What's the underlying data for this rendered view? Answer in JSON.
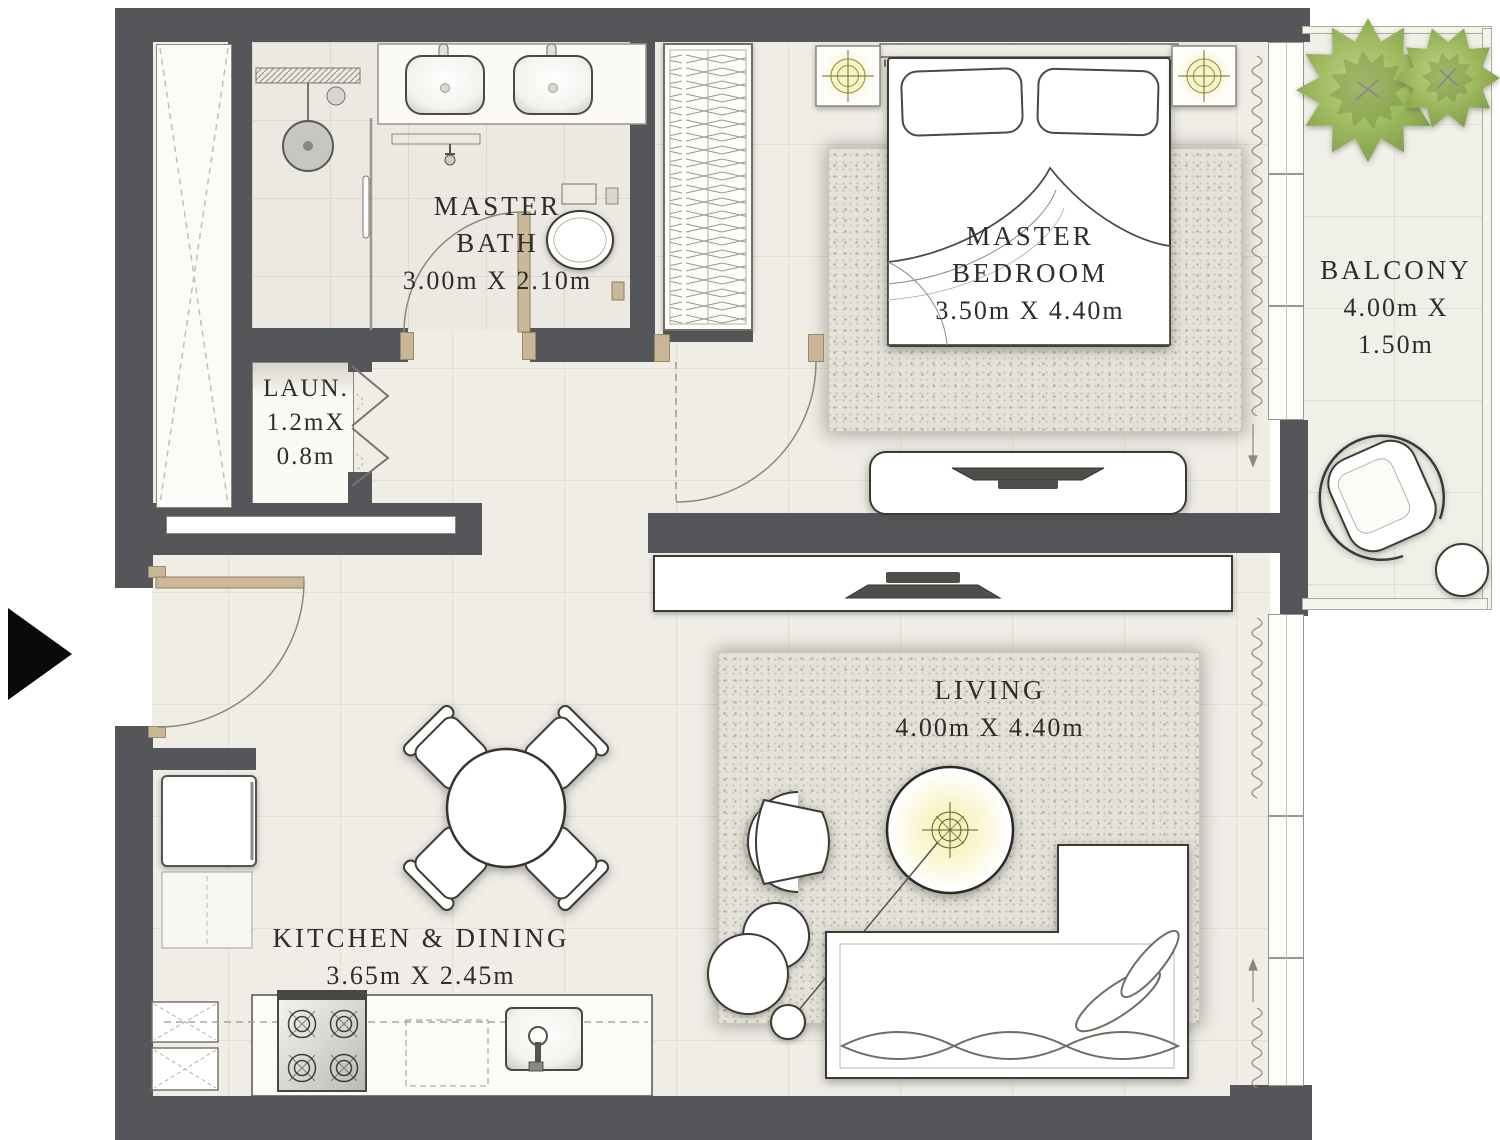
{
  "plan": {
    "colors": {
      "wall": "#55565A",
      "floor": "#EFEDE6",
      "rug": "#E3E1D8",
      "door": "#C8B697",
      "text": "#2E2D2B",
      "tree": "#9DB95E",
      "lamp_glow": "#F1EAAE"
    },
    "rooms": {
      "master_bath": {
        "lines": [
          "MASTER",
          "BATH",
          "3.00m X 2.10m"
        ]
      },
      "laundry": {
        "lines": [
          "LAUN.",
          "1.2mX",
          "0.8m"
        ]
      },
      "master_bedroom": {
        "lines": [
          "MASTER",
          "BEDROOM",
          "3.50m X 4.40m"
        ]
      },
      "balcony": {
        "lines": [
          "BALCONY",
          "4.00m X",
          "1.50m"
        ]
      },
      "living": {
        "lines": [
          "LIVING",
          "4.00m X 4.40m"
        ]
      },
      "kitchen_dining": {
        "lines": [
          "KITCHEN & DINING",
          "3.65m X 2.45m"
        ]
      }
    }
  }
}
